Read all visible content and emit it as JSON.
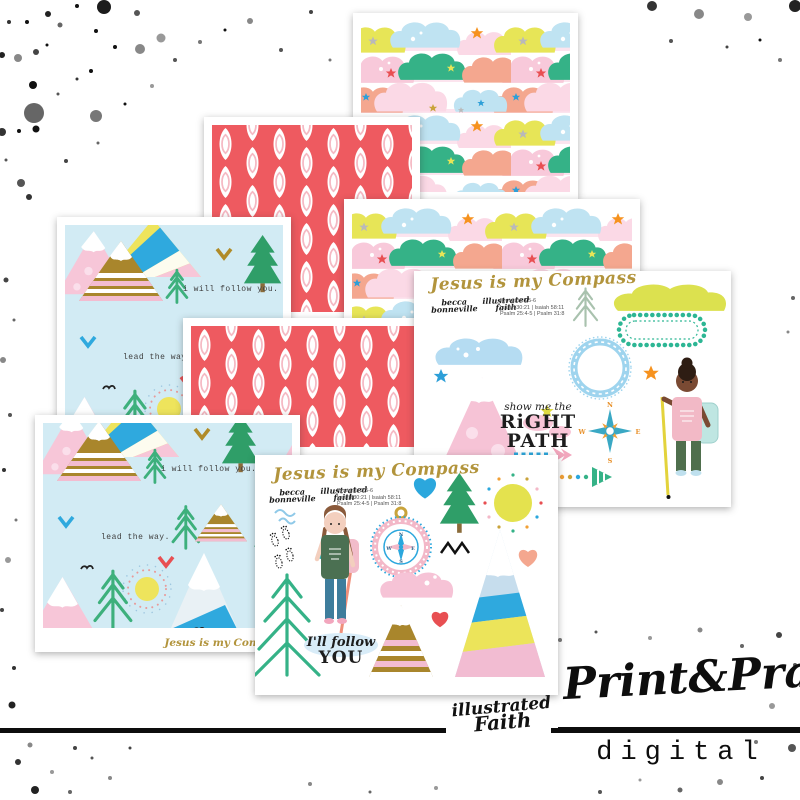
{
  "colors": {
    "red_paper": "#ee5a60",
    "leaf_inner_pink": "#f5b9c3",
    "mountain_bg": "#d2ebf4",
    "gold_title": "#b2943c",
    "cloud_yellow": "#e7e557",
    "cloud_blue": "#bfe3f2",
    "cloud_green": "#35b287",
    "cloud_pink": "#f8c9da",
    "cloud_peach": "#f4a78f",
    "cloud_palepink": "#fbd9e6",
    "ink": "#111111"
  },
  "papers": {
    "mountain": {
      "phrase_follow": "i will follow you.",
      "phrase_lead": "lead the way.",
      "footer_title": "Jesus is my Compass"
    }
  },
  "sticker_right": {
    "title": "Jesus is my Compass",
    "credits": {
      "becca_1": "becca",
      "becca_2": "bonneville",
      "if_1": "illustrated",
      "if_2": "faith"
    },
    "scripture_1": "Proverbs 3:5-6",
    "scripture_2": "Isaiah 30:21 | Isaiah 58:11",
    "scripture_3": "Psalm 25:4-5 | Psalm 31:8",
    "phrase_1": "show me the",
    "phrase_2": "RiGHT",
    "phrase_3": "PATH",
    "compass": {
      "n": "N",
      "e": "E",
      "s": "S",
      "w": "W"
    }
  },
  "sticker_bottom": {
    "title": "Jesus is my Compass",
    "credits": {
      "becca_1": "becca",
      "becca_2": "bonneville",
      "if_1": "illustrated",
      "if_2": "faith"
    },
    "scripture_1": "Proverbs 3:5-6",
    "scripture_2": "Isaiah 30:21 | Isaiah 58:11",
    "scripture_3": "Psalm 25:4-5 | Psalm 31:8",
    "phrase_1": "I'll follow",
    "phrase_2": "YOU",
    "compass": {
      "n": "N",
      "e": "E",
      "s": "S",
      "w": "W"
    }
  },
  "branding": {
    "studio_1": "illustrated",
    "studio_2": "Faith",
    "brand": "Print&Pray",
    "product_type": "digital"
  }
}
